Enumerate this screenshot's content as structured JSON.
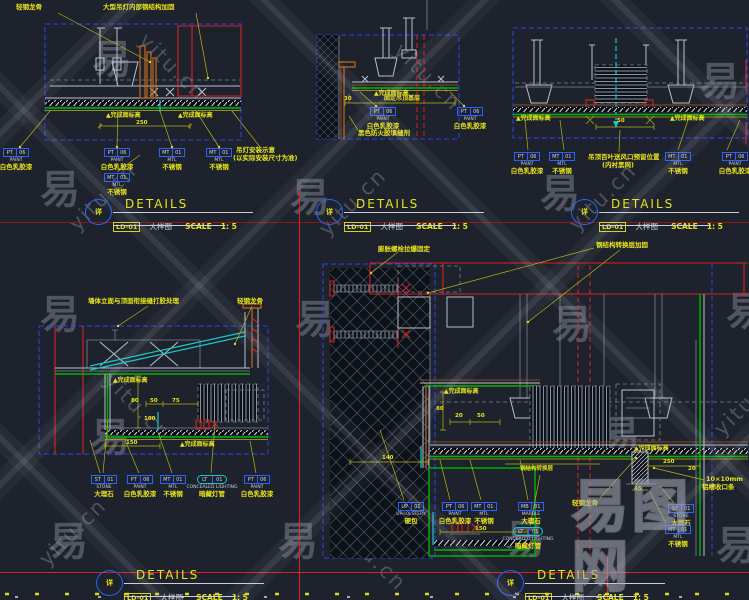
{
  "watermark": {
    "glyph": "易",
    "site": "yitu.cn",
    "logo": "易图网"
  },
  "colors": {
    "background": "#1d222c",
    "border_blue": "#2a46e8",
    "finish_green": "#00b400",
    "annotation_yellow": "#e8e41a",
    "construction_red": "#d82222",
    "dark_red": "#8c1818",
    "cyan": "#18c8c8",
    "line_grey": "#b9c0cd",
    "wood_orange": "#c06820"
  },
  "title_block": {
    "bubble": "详",
    "code": "LD-01",
    "title": "DETAILS",
    "subtitle": "大样图",
    "scale_label": "SCALE",
    "scale_value": "1: 5"
  },
  "details": {
    "d1": {
      "top_labels": [
        "轻钢龙骨",
        "大型吊灯内部钢结构加固"
      ],
      "finish_label": "▲完成面标高",
      "dim": "250",
      "note": [
        "吊灯安装示意",
        "(以实际安装尺寸为准)"
      ],
      "callouts": [
        {
          "c1": "PT",
          "c2": "06",
          "l1": "PAINT",
          "l2": "白色乳胶漆"
        },
        {
          "c1": "PT",
          "c2": "06",
          "l1": "PAINT",
          "l2": "白色乳胶漆"
        },
        {
          "c1": "MT",
          "c2": "01",
          "l1": "MTL",
          "l2": "不锈钢"
        },
        {
          "c1": "MT",
          "c2": "01",
          "l1": "MTL",
          "l2": "不锈钢"
        },
        {
          "c1": "MT",
          "c2": "01",
          "l1": "MTL",
          "l2": "不锈钢"
        }
      ]
    },
    "d2": {
      "finish_label": "▲完成面标高",
      "mid_note": "固定吊顶基层",
      "dim": "30",
      "bottom_note": "黑色防火胶填缝剂",
      "callouts": [
        {
          "c1": "PT",
          "c2": "06",
          "l1": "PAINT",
          "l2": "白色乳胶漆"
        },
        {
          "c1": "PT",
          "c2": "06",
          "l1": "PAINT",
          "l2": "白色乳胶漆"
        }
      ]
    },
    "d3": {
      "finish_label": "▲完成面标高",
      "dim": "50",
      "center": [
        "吊顶百叶送风口预留位置",
        "(内衬黑网)"
      ],
      "callouts": [
        {
          "c1": "PT",
          "c2": "06",
          "l1": "PAINT",
          "l2": "白色乳胶漆"
        },
        {
          "c1": "MT",
          "c2": "01",
          "l1": "MTL",
          "l2": "不锈钢"
        },
        {
          "c1": "MT",
          "c2": "01",
          "l1": "MTL",
          "l2": "不锈钢"
        },
        {
          "c1": "PT",
          "c2": "06",
          "l1": "PAINT",
          "l2": "白色乳胶漆"
        }
      ]
    },
    "d4": {
      "top_labels": [
        "墙体立面与顶面衔接缝打胶处理",
        "轻钢龙骨"
      ],
      "finish_label": "▲完成面标高",
      "dims": [
        "80",
        "50",
        "75",
        "100",
        "150"
      ],
      "callouts": [
        {
          "c1": "ST",
          "c2": "01",
          "l1": "STONE",
          "l2": "大理石"
        },
        {
          "c1": "PT",
          "c2": "06",
          "l1": "PAINT",
          "l2": "白色乳胶漆"
        },
        {
          "c1": "MT",
          "c2": "01",
          "l1": "MTL",
          "l2": "不锈钢"
        },
        {
          "c1": "LT",
          "c2": "01",
          "l1": "CONCEALED LIGHTING",
          "l2": "暗藏灯管"
        },
        {
          "c1": "PT",
          "c2": "06",
          "l1": "PAINT",
          "l2": "白色乳胶漆"
        }
      ]
    },
    "d5": {
      "top_labels": [
        "膨胀螺栓拉爆固定",
        "钢结构转换层加固"
      ],
      "right_labels": [
        "轻钢龙骨",
        "10×10mm",
        "铝槽收口条"
      ],
      "finish_label": "▲完成面标高",
      "dims": [
        "140",
        "80",
        "20",
        "50",
        "250",
        "20",
        "45",
        "150"
      ],
      "dim_note": "钢结构转换层",
      "side_callouts": [
        {
          "c1": "ST",
          "c2": "01",
          "l1": "STONE",
          "l2": "大理石"
        },
        {
          "c1": "MT",
          "c2": "01",
          "l1": "MTL",
          "l2": "不锈钢"
        }
      ],
      "callouts": [
        {
          "c1": "UP",
          "c2": "01",
          "l1": "UPHOLSTERY",
          "l2": "硬包"
        },
        {
          "c1": "PT",
          "c2": "06",
          "l1": "PAINT",
          "l2": "白色乳胶漆"
        },
        {
          "c1": "MT",
          "c2": "01",
          "l1": "MTL",
          "l2": "不锈钢"
        },
        {
          "c1": "MB",
          "c2": "01",
          "l1": "MARBLE",
          "l2": "大理石"
        },
        {
          "c1": "LT",
          "c2": "01",
          "l1": "CONCEALED LIGHTING",
          "l2": "暗藏灯管"
        }
      ]
    }
  }
}
